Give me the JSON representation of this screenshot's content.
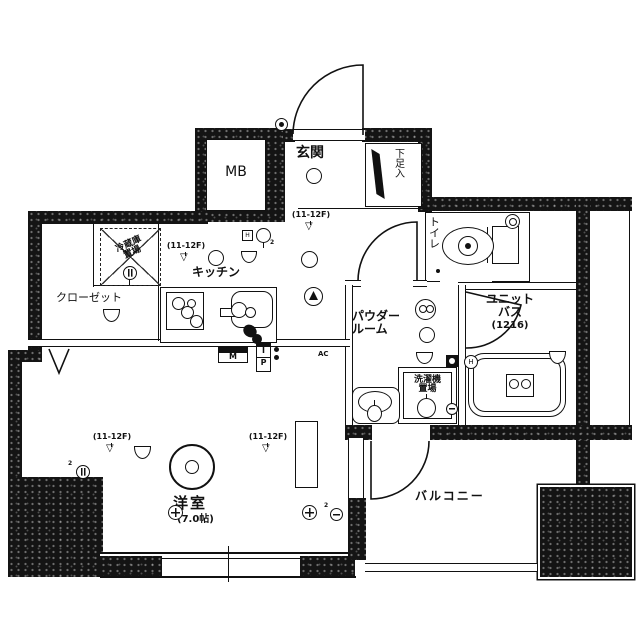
{
  "page": {
    "background": "#ffffff",
    "ink": "#111111"
  },
  "labels": {
    "mb": "MB",
    "genkan": "玄関",
    "shoe": "下足入",
    "toilet": "トイレ",
    "kitchen": "キッチン",
    "closet": "クローゼット",
    "fridge1": "冷蔵庫",
    "fridge2": "置場",
    "powder1": "パウダー",
    "powder2": "ルーム",
    "bath1": "ユニット",
    "bath2": "バス",
    "bath_size": "(1216)",
    "laundry1": "洗濯機",
    "laundry2": "置場",
    "western": "洋室",
    "western_size": "(7.0帖)",
    "balcony": "バルコニー",
    "floor_note": "(11-12F)",
    "meter": "M",
    "ip_i": "I",
    "ip_p": "P",
    "ac": "AC",
    "h": "H",
    "sup2": "2"
  },
  "icons": {
    "sprinkler": "▽"
  }
}
